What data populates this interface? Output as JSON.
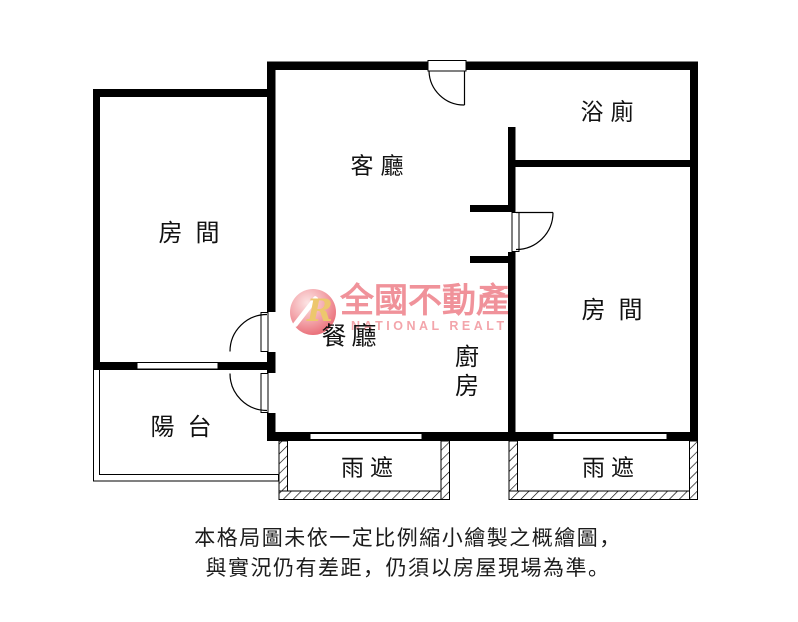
{
  "page": {
    "background": "#ffffff",
    "wall_color": "#000000",
    "label_color": "#111111"
  },
  "rooms": {
    "living": "客廳",
    "bath": "浴廁",
    "bedroom_left": "房間",
    "bedroom_right": "房間",
    "dining": "餐廳",
    "kitchen": "廚房",
    "balcony": "陽台",
    "canopy_left": "雨遮",
    "canopy_right": "雨遮"
  },
  "watermark": {
    "logo_letter": "R",
    "name_zh": "全國不動產",
    "name_en": "NATIONAL REALTY",
    "text_color": "#f0929a",
    "sphere_color": "#e35460",
    "letter_color": "#edc76d"
  },
  "disclaimer": {
    "line1": "本格局圖未依一定比例縮小繪製之概繪圖，",
    "line2": "與實況仍有差距，仍須以房屋現場為準。"
  }
}
